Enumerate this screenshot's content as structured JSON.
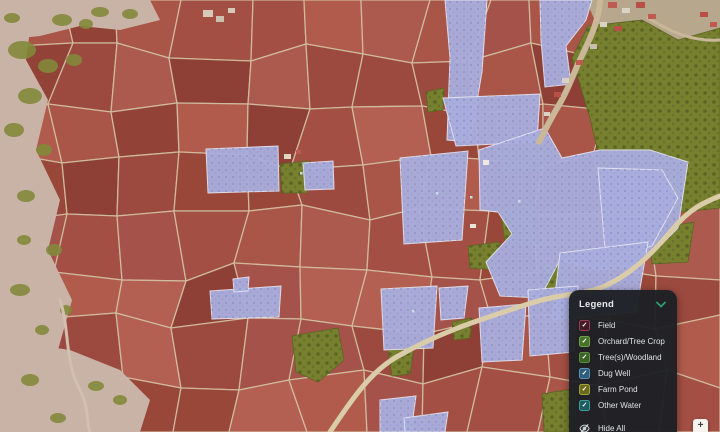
{
  "legend": {
    "title": "Legend",
    "chevron_color": "#2e9e6b",
    "hide_all_label": "Hide All",
    "items": [
      {
        "label": "Field",
        "checked": true,
        "fill": "#451a28",
        "border": "#993d52"
      },
      {
        "label": "Orchard/Tree Crop",
        "checked": true,
        "fill": "#49712c",
        "border": "#6fa048"
      },
      {
        "label": "Tree(s)/Woodland",
        "checked": true,
        "fill": "#3c6326",
        "border": "#5d8f3d"
      },
      {
        "label": "Dug Well",
        "checked": true,
        "fill": "#2e5d7d",
        "border": "#5b93b8"
      },
      {
        "label": "Farm Pond",
        "checked": true,
        "fill": "#6a6a1d",
        "border": "#a3a33b"
      },
      {
        "label": "Other Water",
        "checked": true,
        "fill": "#1d5c60",
        "border": "#3f9d9a"
      }
    ]
  },
  "map_controls": {
    "zoom_in_label": "+"
  },
  "map": {
    "width": 720,
    "height": 432,
    "mosaic": {
      "cols": 12,
      "rows": 8,
      "seed": 7,
      "jitter": 26
    },
    "palette": {
      "field_shades": [
        "#9c4a3f",
        "#a95547",
        "#934238",
        "#b05b4c",
        "#8e4036",
        "#a34f44",
        "#ad5a4e",
        "#984739",
        "#a5524a",
        "#b36052"
      ],
      "line": "#d3c3a6",
      "scrub": "#c9b3a7",
      "scrub_tree": "#83883b",
      "village": "#b7a78c",
      "woodland": "#76802e",
      "orchard": "#a9aede",
      "orchard_edge": "#e4e2f0",
      "road": "#dbcca9",
      "village_path": "#c9b798",
      "well": "#c4dfe8"
    },
    "scrub": [
      [
        [
          0,
          0
        ],
        [
          34,
          0
        ],
        [
          26,
          60
        ],
        [
          48,
          100
        ],
        [
          36,
          150
        ],
        [
          60,
          200
        ],
        [
          48,
          250
        ],
        [
          72,
          300
        ],
        [
          58,
          350
        ],
        [
          92,
          400
        ],
        [
          80,
          432
        ],
        [
          0,
          432
        ]
      ],
      [
        [
          0,
          0
        ],
        [
          150,
          0
        ],
        [
          160,
          20
        ],
        [
          120,
          30
        ],
        [
          80,
          26
        ],
        [
          40,
          36
        ],
        [
          0,
          40
        ]
      ],
      [
        [
          0,
          340
        ],
        [
          70,
          350
        ],
        [
          120,
          370
        ],
        [
          150,
          400
        ],
        [
          140,
          432
        ],
        [
          0,
          432
        ]
      ]
    ],
    "scrub_blobs": [
      [
        22,
        50,
        14,
        9
      ],
      [
        48,
        66,
        10,
        7
      ],
      [
        30,
        96,
        12,
        8
      ],
      [
        14,
        130,
        10,
        7
      ],
      [
        44,
        150,
        8,
        6
      ],
      [
        26,
        196,
        9,
        6
      ],
      [
        54,
        250,
        8,
        6
      ],
      [
        20,
        290,
        10,
        6
      ],
      [
        42,
        330,
        7,
        5
      ],
      [
        30,
        380,
        9,
        6
      ],
      [
        74,
        60,
        8,
        6
      ],
      [
        12,
        18,
        8,
        5
      ],
      [
        62,
        20,
        10,
        6
      ],
      [
        100,
        12,
        9,
        5
      ],
      [
        130,
        14,
        8,
        5
      ],
      [
        86,
        24,
        7,
        5
      ],
      [
        24,
        240,
        7,
        5
      ],
      [
        66,
        310,
        6,
        5
      ],
      [
        96,
        386,
        8,
        5
      ],
      [
        120,
        400,
        7,
        5
      ],
      [
        58,
        418,
        8,
        5
      ]
    ],
    "village": [
      [
        [
          586,
          0
        ],
        [
          720,
          0
        ],
        [
          720,
          44
        ],
        [
          676,
          40
        ],
        [
          640,
          24
        ],
        [
          598,
          28
        ]
      ]
    ],
    "woodland": [
      [
        [
          588,
          26
        ],
        [
          642,
          20
        ],
        [
          678,
          40
        ],
        [
          720,
          28
        ],
        [
          720,
          208
        ],
        [
          662,
          214
        ],
        [
          640,
          190
        ],
        [
          602,
          170
        ],
        [
          590,
          118
        ],
        [
          572,
          58
        ]
      ],
      [
        [
          497,
          148
        ],
        [
          552,
          146
        ],
        [
          540,
          170
        ],
        [
          500,
          172
        ]
      ],
      [
        [
          500,
          208
        ],
        [
          534,
          204
        ],
        [
          540,
          242
        ],
        [
          506,
          248
        ]
      ],
      [
        [
          468,
          246
        ],
        [
          500,
          242
        ],
        [
          496,
          270
        ],
        [
          470,
          268
        ]
      ],
      [
        [
          280,
          164
        ],
        [
          310,
          161
        ],
        [
          307,
          193
        ],
        [
          282,
          193
        ]
      ],
      [
        [
          292,
          336
        ],
        [
          338,
          328
        ],
        [
          344,
          360
        ],
        [
          318,
          382
        ],
        [
          296,
          372
        ]
      ],
      [
        [
          388,
          350
        ],
        [
          414,
          346
        ],
        [
          410,
          374
        ],
        [
          392,
          376
        ]
      ],
      [
        [
          540,
          266
        ],
        [
          568,
          260
        ],
        [
          574,
          292
        ],
        [
          546,
          298
        ]
      ],
      [
        [
          542,
          394
        ],
        [
          578,
          388
        ],
        [
          574,
          432
        ],
        [
          544,
          432
        ]
      ],
      [
        [
          648,
          230
        ],
        [
          694,
          222
        ],
        [
          688,
          262
        ],
        [
          652,
          264
        ]
      ],
      [
        [
          452,
          322
        ],
        [
          472,
          318
        ],
        [
          470,
          338
        ],
        [
          454,
          340
        ]
      ],
      [
        [
          426,
          92
        ],
        [
          444,
          88
        ],
        [
          443,
          110
        ],
        [
          428,
          112
        ]
      ]
    ],
    "orchards": [
      [
        [
          445,
          0
        ],
        [
          487,
          0
        ],
        [
          482,
          72
        ],
        [
          470,
          142
        ],
        [
          447,
          140
        ],
        [
          450,
          58
        ]
      ],
      [
        [
          540,
          0
        ],
        [
          592,
          0
        ],
        [
          586,
          20
        ],
        [
          566,
          46
        ],
        [
          571,
          84
        ],
        [
          545,
          87
        ],
        [
          541,
          40
        ]
      ],
      [
        [
          443,
          98
        ],
        [
          540,
          94
        ],
        [
          537,
          142
        ],
        [
          456,
          146
        ]
      ],
      [
        [
          400,
          158
        ],
        [
          468,
          151
        ],
        [
          462,
          240
        ],
        [
          404,
          244
        ]
      ],
      [
        [
          479,
          150
        ],
        [
          545,
          128
        ],
        [
          562,
          158
        ],
        [
          600,
          150
        ],
        [
          650,
          150
        ],
        [
          688,
          162
        ],
        [
          678,
          228
        ],
        [
          640,
          266
        ],
        [
          600,
          270
        ],
        [
          560,
          260
        ],
        [
          540,
          298
        ],
        [
          500,
          296
        ],
        [
          486,
          262
        ],
        [
          512,
          234
        ],
        [
          498,
          212
        ],
        [
          480,
          210
        ]
      ],
      [
        [
          598,
          168
        ],
        [
          662,
          170
        ],
        [
          678,
          198
        ],
        [
          652,
          246
        ],
        [
          606,
          260
        ]
      ],
      [
        [
          560,
          253
        ],
        [
          648,
          242
        ],
        [
          636,
          312
        ],
        [
          552,
          320
        ]
      ],
      [
        [
          381,
          289
        ],
        [
          437,
          286
        ],
        [
          433,
          348
        ],
        [
          384,
          350
        ]
      ],
      [
        [
          439,
          288
        ],
        [
          468,
          286
        ],
        [
          464,
          318
        ],
        [
          441,
          320
        ]
      ],
      [
        [
          479,
          308
        ],
        [
          526,
          304
        ],
        [
          522,
          360
        ],
        [
          482,
          362
        ]
      ],
      [
        [
          528,
          290
        ],
        [
          578,
          286
        ],
        [
          574,
          352
        ],
        [
          530,
          356
        ]
      ],
      [
        [
          380,
          400
        ],
        [
          416,
          396
        ],
        [
          411,
          432
        ],
        [
          380,
          432
        ]
      ],
      [
        [
          404,
          418
        ],
        [
          448,
          412
        ],
        [
          445,
          432
        ],
        [
          405,
          432
        ]
      ],
      [
        [
          210,
          291
        ],
        [
          281,
          286
        ],
        [
          279,
          317
        ],
        [
          212,
          319
        ]
      ],
      [
        [
          233,
          279
        ],
        [
          249,
          277
        ],
        [
          248,
          291
        ],
        [
          234,
          292
        ]
      ],
      [
        [
          206,
          149
        ],
        [
          278,
          146
        ],
        [
          279,
          191
        ],
        [
          208,
          193
        ]
      ],
      [
        [
          303,
          163
        ],
        [
          333,
          161
        ],
        [
          334,
          189
        ],
        [
          305,
          190
        ]
      ]
    ],
    "roads": [
      {
        "d": "M 330 432 C 355 395 372 370 400 355 C 445 330 480 320 525 305 C 560 293 585 295 605 286 C 635 272 655 250 672 230 C 690 208 705 202 720 196",
        "w": 5,
        "c": "#dbcca9"
      },
      {
        "d": "M 600 2 C 598 26 586 46 578 64 C 572 78 566 94 556 110 C 548 124 544 132 539 142",
        "w": 6,
        "c": "#c9b798"
      },
      {
        "d": "M 648 18 C 668 30 690 42 720 40",
        "w": 3,
        "c": "#c9b798"
      },
      {
        "d": "M 60 300 C 70 330 64 360 80 390 C 90 410 86 424 90 432",
        "w": 3,
        "c": "#d2bfae"
      }
    ],
    "buildings": [
      [
        608,
        2,
        9,
        6,
        "#c05a50"
      ],
      [
        622,
        8,
        8,
        5,
        "#d9d2c6"
      ],
      [
        636,
        2,
        9,
        6,
        "#b85048"
      ],
      [
        648,
        14,
        8,
        5,
        "#c05a50"
      ],
      [
        600,
        22,
        7,
        5,
        "#d9d2c6"
      ],
      [
        614,
        26,
        8,
        5,
        "#b85048"
      ],
      [
        590,
        44,
        7,
        5,
        "#c9bfae"
      ],
      [
        576,
        60,
        7,
        5,
        "#c05a50"
      ],
      [
        562,
        78,
        7,
        5,
        "#d9d2c6"
      ],
      [
        554,
        92,
        7,
        5,
        "#b85048"
      ],
      [
        544,
        112,
        6,
        4,
        "#d9d2c6"
      ],
      [
        470,
        224,
        6,
        4,
        "#e8e4da"
      ],
      [
        483,
        160,
        6,
        5,
        "#eee9df"
      ],
      [
        284,
        154,
        7,
        5,
        "#ded5c5"
      ],
      [
        296,
        150,
        5,
        4,
        "#c05a50"
      ],
      [
        203,
        10,
        10,
        7,
        "#d6c9ba"
      ],
      [
        216,
        16,
        8,
        6,
        "#cdbfae"
      ],
      [
        228,
        8,
        7,
        5,
        "#d6c9ba"
      ],
      [
        700,
        12,
        8,
        5,
        "#b85048"
      ],
      [
        710,
        22,
        7,
        5,
        "#c05a50"
      ]
    ],
    "wells": [
      [
        436,
        192
      ],
      [
        470,
        196
      ],
      [
        518,
        200
      ],
      [
        412,
        310
      ],
      [
        300,
        172
      ]
    ]
  }
}
